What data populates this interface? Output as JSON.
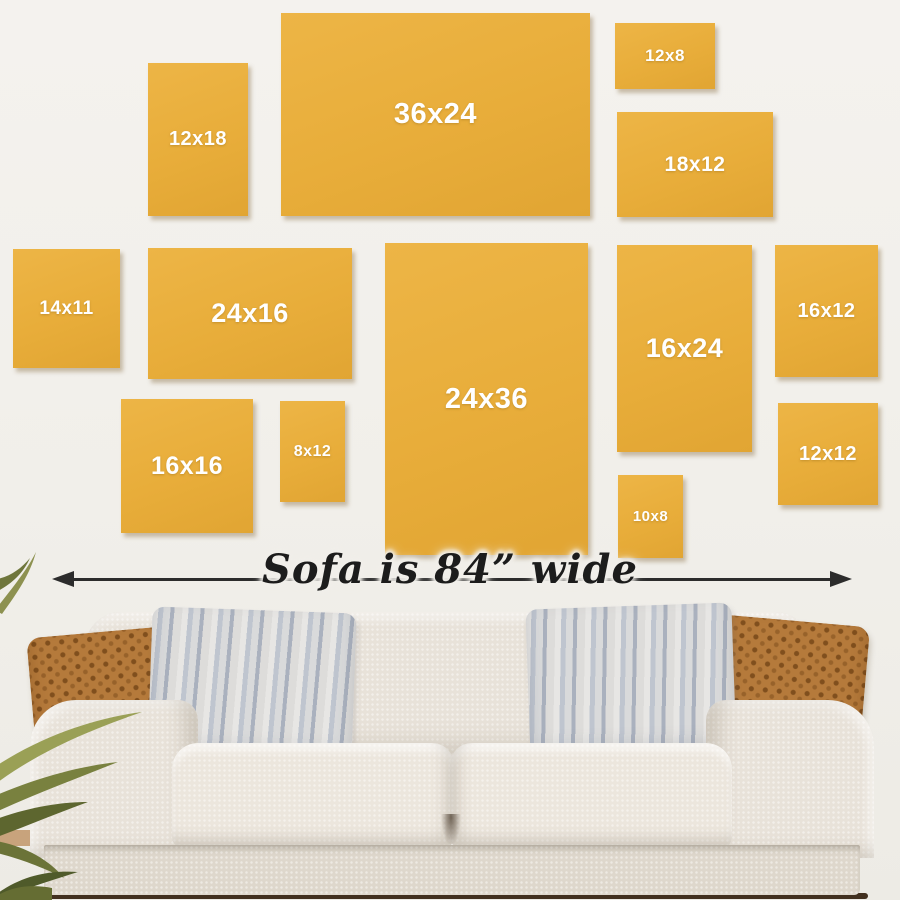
{
  "scene": {
    "caption": "Sofa is 84” wide"
  },
  "frames": [
    {
      "label": "12x18"
    },
    {
      "label": "36x24"
    },
    {
      "label": "12x8"
    },
    {
      "label": "18x12"
    },
    {
      "label": "14x11"
    },
    {
      "label": "24x16"
    },
    {
      "label": "24x36"
    },
    {
      "label": "16x24"
    },
    {
      "label": "16x12"
    },
    {
      "label": "16x16"
    },
    {
      "label": "8x12"
    },
    {
      "label": "10x8"
    },
    {
      "label": "12x12"
    }
  ],
  "colors": {
    "canvas_accent": "#E8AD3A",
    "canvas_text": "#FFFFFF",
    "wall": "#F1EFEA",
    "arrow": "#2C2C2C",
    "sofa_fabric": "#E8E2D9",
    "pillow_brown": "#B57A3B",
    "pillow_gray": "#BFC5CF",
    "floor": "#42301F",
    "plant_green": "#79813F"
  }
}
